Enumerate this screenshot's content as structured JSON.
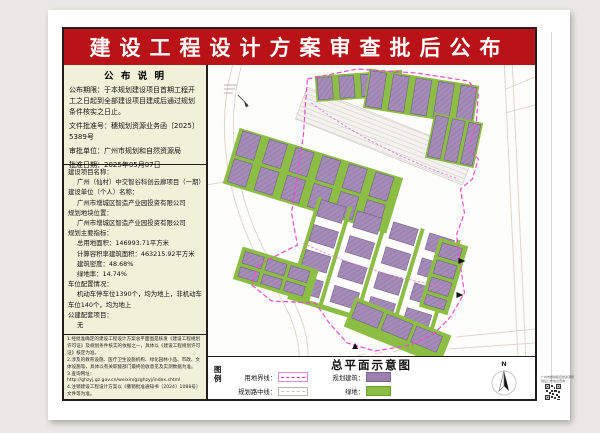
{
  "banner": {
    "title": "建设工程设计工程方案审查批后公布"
  },
  "banner_fix": {
    "title": "建设工程设计方案审查批后公布"
  },
  "announcement": {
    "header": "公 布 说 明",
    "lines": [
      "公布期限：于本规划建设项目首期工程开工之日起到全部建设项目建成后通过规划条件核实之日止。",
      "文件批准号：穗规划资源业务函〔2025〕5389号",
      "审批单位：广州市规划和自然资源局",
      "批准日期：2025年05月07日"
    ]
  },
  "project": {
    "lines": [
      {
        "t": "label",
        "text": "建设项目名称："
      },
      {
        "t": "value",
        "text": "广州（仙村）中交智谷科创云廊项目（一期）"
      },
      {
        "t": "label",
        "text": "建设单位（个人）名称："
      },
      {
        "t": "value",
        "text": "广州市增城区智造产业园投资有限公司"
      },
      {
        "t": "label",
        "text": "规划地块位置："
      },
      {
        "t": "value",
        "text": "广州市增城区智造产业园投资有限公司"
      },
      {
        "t": "label",
        "text": "规划主要指标："
      },
      {
        "t": "value",
        "text": "总用地面积：146993.71平方米"
      },
      {
        "t": "value",
        "text": "计算容积率建筑面积：463215.92平方米"
      },
      {
        "t": "value",
        "text": "建筑密度：48.68%"
      },
      {
        "t": "value",
        "text": "绿地率：14.74%"
      },
      {
        "t": "label",
        "text": "车位配置情况："
      },
      {
        "t": "value",
        "text": "机动车停车位1390个，均为地上，非机动车车位140个，均为地上"
      },
      {
        "t": "label",
        "text": "公建配套项目："
      },
      {
        "t": "value",
        "text": "无"
      }
    ]
  },
  "notes": {
    "lines": [
      "1.经批准确定的建设工程设计方案总平面图是核发《建设工程规划许可证》及规划条件核实的依据之一，具体以《建设工程规划许可证》核定为准。",
      "2.涉及的教育设施、医疗卫生设施机构、绿化园林小品、市政、文体设施等，具体以有关职能部门最终验收意见及实测数据为准。",
      "3.查询网址：http://ghzyj.gz.gov.cn/weixin/gzghzyj/index.shtml",
      "4.注销建设工程设计方案以《撤销批准通知书〔2024〕1088号〕文件等为准。"
    ]
  },
  "legend": {
    "label": "图例",
    "map_title": "总平面示意图",
    "items": {
      "boundary": "用地界线：",
      "centerline": "规划路中线：",
      "building": "规划建筑：",
      "green": "绿地："
    },
    "north_label": "N"
  },
  "qr": {
    "caption_line1": "广州市规划和自然资源局",
    "caption_line2": "批后公布信息查询"
  },
  "colors": {
    "banner_red": "#b91318",
    "panel_yellow": "#f1f1d9",
    "building_purple": "#a58bb7",
    "green": "#8cbd45",
    "boundary_pink": "#ef4ecf"
  }
}
